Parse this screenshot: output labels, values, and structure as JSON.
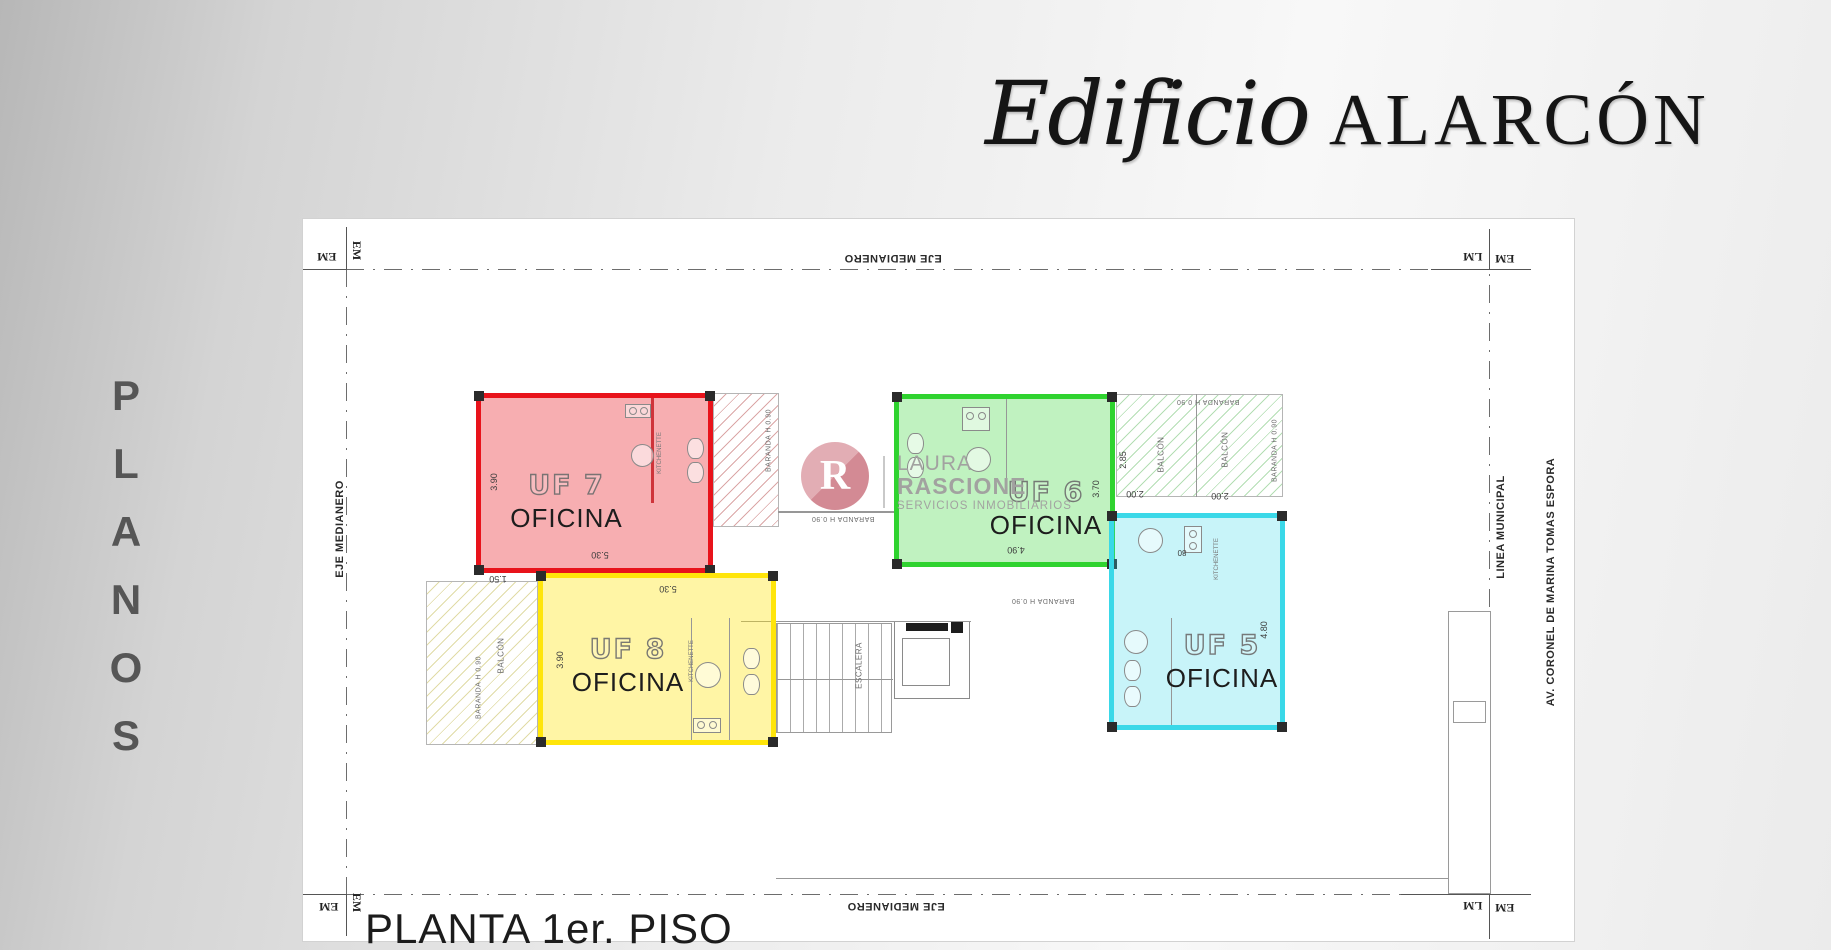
{
  "page": {
    "title_script": "Edificio",
    "title_caps": "ALARCÓN",
    "side_letters": [
      "P",
      "L",
      "A",
      "N",
      "O",
      "S"
    ],
    "floor_title": "PLANTA 1er. PISO"
  },
  "plan": {
    "labels": {
      "eje_medianero": "EJE MEDIANERO",
      "linea_municipal": "LINEA MUNICIPAL",
      "avenue": "AV. CORONEL DE MARINA TOMAS ESPORA",
      "em": "EM",
      "lm": "LM",
      "balcon": "BALCÓN",
      "baranda": "BARANDA H 0.90",
      "escalera": "ESCALERA",
      "kitchenette": "KITCHENETTE"
    },
    "rooms": [
      {
        "unit": "UF 7",
        "use": "OFICINA",
        "color": "#e8131b",
        "dim_w": "5.30",
        "dim_h": "3.90"
      },
      {
        "unit": "UF 8",
        "use": "OFICINA",
        "color": "#ffe50a",
        "dim_w": "5.30",
        "dim_h": "3.90",
        "dim_balcony": "1.50"
      },
      {
        "unit": "UF 6",
        "use": "OFICINA",
        "color": "#2fd32f",
        "dim_w": "4.90",
        "dim_h": "3.70",
        "dim_balcony_depth": "2.85",
        "dim_balcony_w1": "2.00",
        "dim_balcony_w2": "2.00"
      },
      {
        "unit": "UF 5",
        "use": "OFICINA",
        "color": "#3ad8e8",
        "dim_side": "4.80",
        "dim_kitchen": "80"
      }
    ]
  },
  "watermark": {
    "initial": "R",
    "name_line1": "LAURA",
    "name_line2": "RASCIONE",
    "tagline": "SERVICIOS INMOBILIARIOS",
    "accent": "#d5858f"
  }
}
